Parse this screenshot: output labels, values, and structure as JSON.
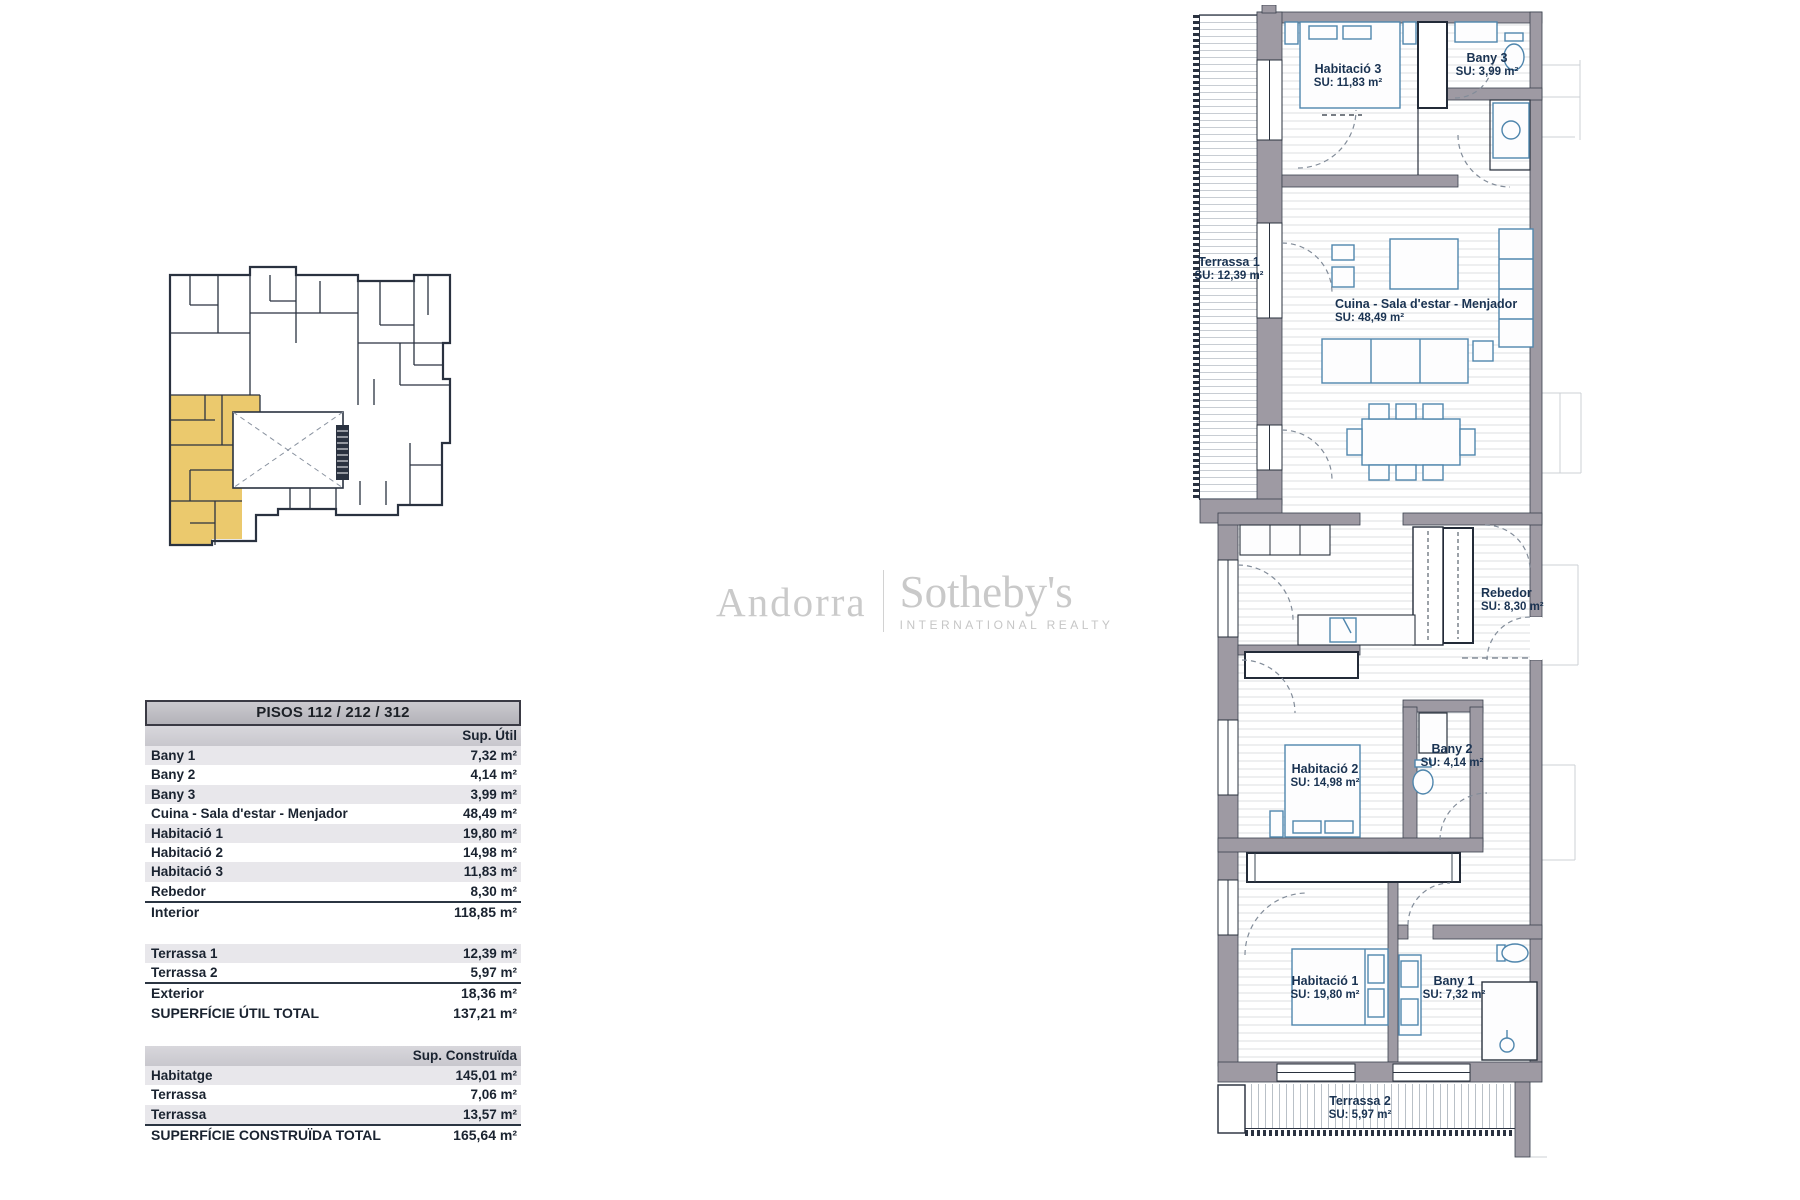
{
  "logo": {
    "left": "Andorra",
    "right": "Sotheby's",
    "tagline": "INTERNATIONAL REALTY"
  },
  "tables": {
    "util": {
      "title": "PISOS 112 / 212 / 312",
      "col_header": "Sup. Útil",
      "rows": [
        {
          "label": "Bany 1",
          "value": "7,32 m²",
          "shaded": true
        },
        {
          "label": "Bany 2",
          "value": "4,14 m²",
          "shaded": false
        },
        {
          "label": "Bany 3",
          "value": "3,99 m²",
          "shaded": true
        },
        {
          "label": "Cuina - Sala d'estar - Menjador",
          "value": "48,49 m²",
          "shaded": false
        },
        {
          "label": "Habitació 1",
          "value": "19,80 m²",
          "shaded": true
        },
        {
          "label": "Habitació 2",
          "value": "14,98 m²",
          "shaded": false
        },
        {
          "label": "Habitació 3",
          "value": "11,83 m²",
          "shaded": true
        },
        {
          "label": "Rebedor",
          "value": "8,30 m²",
          "shaded": false
        }
      ],
      "interior_row": {
        "label": "Interior",
        "value": "118,85 m²"
      },
      "exterior_rows": [
        {
          "label": "Terrassa 1",
          "value": "12,39 m²",
          "shaded": true
        },
        {
          "label": "Terrassa 2",
          "value": "5,97 m²",
          "shaded": false
        }
      ],
      "exterior_total": {
        "label": "Exterior",
        "value": "18,36 m²"
      },
      "grand_total": {
        "label": "SUPERFÍCIE ÚTIL TOTAL",
        "value": "137,21 m²"
      }
    },
    "construida": {
      "col_header": "Sup. Construïda",
      "rows": [
        {
          "label": "Habitatge",
          "value": "145,01 m²",
          "shaded": true
        },
        {
          "label": "Terrassa",
          "value": "7,06 m²",
          "shaded": false
        },
        {
          "label": "Terrassa",
          "value": "13,57 m²",
          "shaded": true
        }
      ],
      "total": {
        "label": "SUPERFÍCIE CONSTRUÏDA TOTAL",
        "value": "165,64 m²"
      }
    }
  },
  "floorplan": {
    "rooms": [
      {
        "name": "Habitació 3",
        "su": "SU: 11,83 m²"
      },
      {
        "name": "Bany 3",
        "su": "SU: 3,99 m²"
      },
      {
        "name": "Terrassa 1",
        "su": "SU: 12,39 m²"
      },
      {
        "name": "Cuina - Sala d'estar - Menjador",
        "su": "SU: 48,49 m²"
      },
      {
        "name": "Rebedor",
        "su": "SU: 8,30 m²"
      },
      {
        "name": "Habitació 2",
        "su": "SU: 14,98 m²"
      },
      {
        "name": "Bany 2",
        "su": "SU: 4,14 m²"
      },
      {
        "name": "Habitació 1",
        "su": "SU: 19,80 m²"
      },
      {
        "name": "Bany 1",
        "su": "SU: 7,32 m²"
      },
      {
        "name": "Terrassa 2",
        "su": "SU: 5,97 m²"
      }
    ],
    "colors": {
      "wall_gray": "#9e9aa3",
      "line_dark": "#2a323e",
      "furniture_blue": "#4f86ad",
      "highlight_yellow": "#ebc96d",
      "label_navy": "#1a3352"
    }
  }
}
